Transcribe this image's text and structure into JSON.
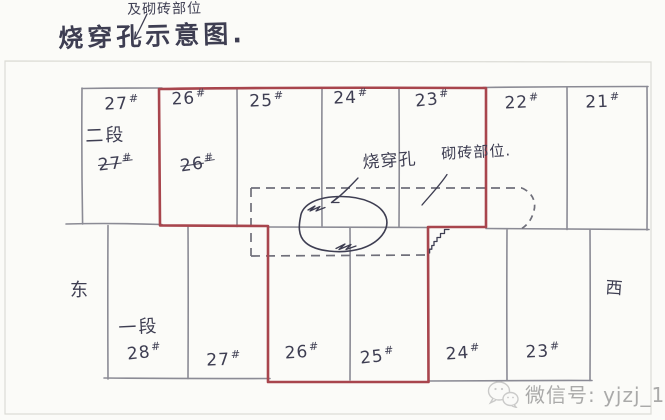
{
  "page": {
    "annotation_top": "及砌砖部位",
    "title": "烧穿孔示意图.",
    "east": "东",
    "west": "西"
  },
  "top_row": {
    "section_label": "二段",
    "crossed_27": {
      "num": "27",
      "hash": "#"
    },
    "crossed_26": {
      "num": "26",
      "hash": "#"
    },
    "cells": [
      {
        "num": "27",
        "hash": "#"
      },
      {
        "num": "26",
        "hash": "#"
      },
      {
        "num": "25",
        "hash": "#"
      },
      {
        "num": "24",
        "hash": "#"
      },
      {
        "num": "23",
        "hash": "#"
      },
      {
        "num": "22",
        "hash": "#"
      },
      {
        "num": "21",
        "hash": "#"
      }
    ]
  },
  "bottom_row": {
    "section_label": "一段",
    "cells": [
      {
        "num": "28",
        "hash": "#"
      },
      {
        "num": "27",
        "hash": "#"
      },
      {
        "num": "26",
        "hash": "#"
      },
      {
        "num": "25",
        "hash": "#"
      },
      {
        "num": "24",
        "hash": "#"
      },
      {
        "num": "23",
        "hash": "#"
      }
    ]
  },
  "annotations": {
    "burn_hole": "烧穿孔",
    "brick_area": "砌砖部位."
  },
  "watermark": {
    "icon": "wechat-icon",
    "text": "微信号: yjzj_13"
  },
  "colors": {
    "highlight_red": "#a8454d",
    "pencil_gray": "#8b8b95",
    "ink": "#3e3e52",
    "watermark_gray": "#9c9c9c",
    "paper": "#fbfbf8"
  }
}
